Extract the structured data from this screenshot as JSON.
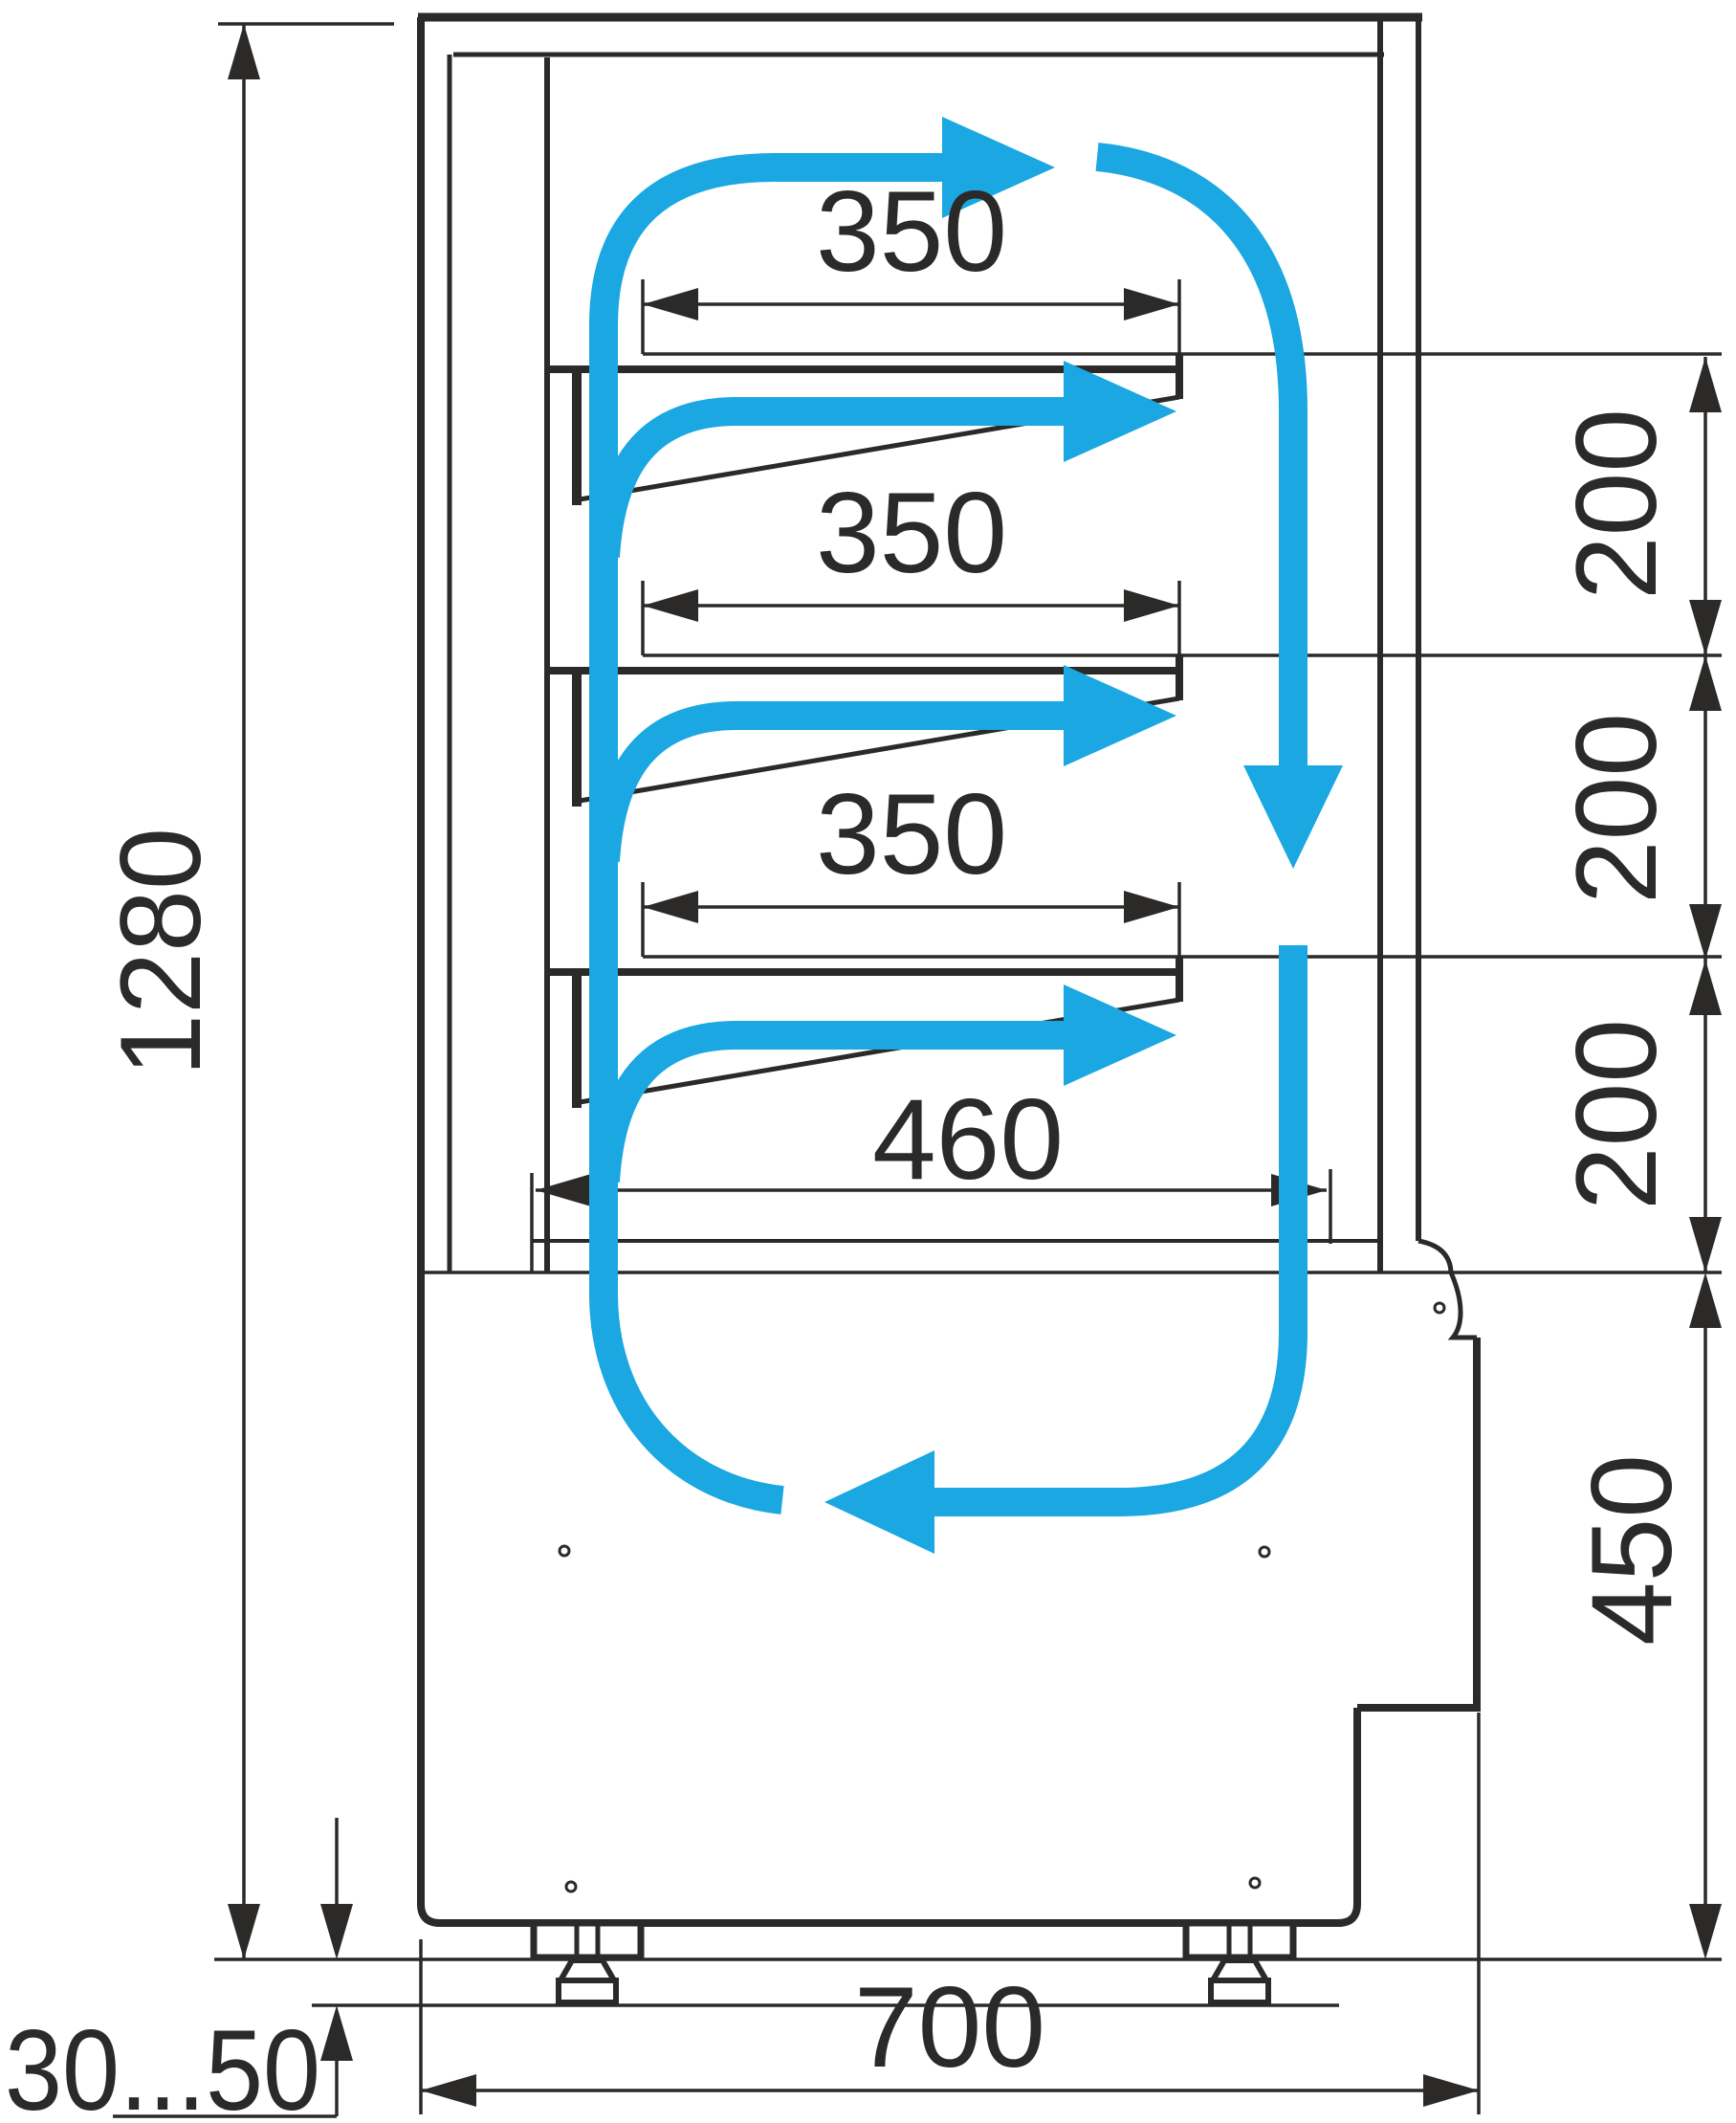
{
  "labels": {
    "overall_height": "1280",
    "shelf1_width": "350",
    "shelf2_width": "350",
    "shelf3_width": "350",
    "gap1": "200",
    "gap2": "200",
    "gap3": "200",
    "bottom_shelf_width": "460",
    "machine_section_height": "450",
    "base_width": "700",
    "leg_height_range": "30...50"
  },
  "colors": {
    "line": "#2B2A29",
    "airflow": "#1AA7E2",
    "background": "#FFFFFF"
  }
}
